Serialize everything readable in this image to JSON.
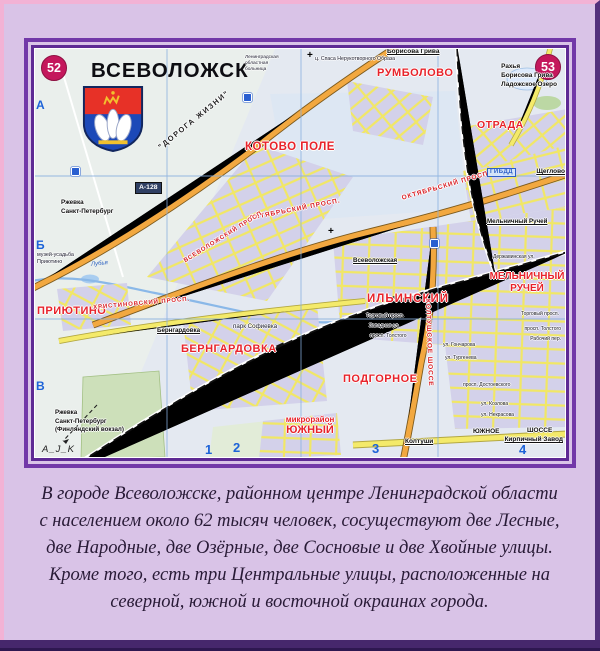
{
  "map": {
    "badge_left": "52",
    "badge_right": "53",
    "title": "ВСЕВОЛОЖСК",
    "districts": {
      "kotovo_pole": "КОТОВО ПОЛЕ",
      "rumbolovo": "РУМБОЛОВО",
      "otrada": "ОТРАДА",
      "priyutino": "ПРИЮТИНО",
      "berngardovka": "БЕРНГАРДОВКА",
      "ilyinsky": "ИЛЬИНСКИЙ",
      "melnichny_1": "МЕЛЬНИЧНЫЙ",
      "melnichny_2": "РУЧЕЙ",
      "podgornoe": "ПОДГОРНОЕ",
      "yuzhny_1": "микрорайон",
      "yuzhny_2": "ЮЖНЫЙ"
    },
    "roads": {
      "doroga_zhizni": "\"ДОРОГА ЖИЗНИ\"",
      "a128": "А-128",
      "oktyabrsky": "ОКТЯБРЬСКИЙ ПРОСП.",
      "koltushskoe": "КОЛТУШСКОЕ ШОССЕ",
      "khristinovsky": "ХРИСТИНОВСКИЙ ПРОСП.",
      "vsevolozhsky": "ВСЕВОЛОЖСКИЙ ПРОСП.",
      "yuzhnoe": "ЮЖНОЕ",
      "shosse": "ШОССЕ"
    },
    "stations": {
      "vsevolozhskaya": "Всеволожская",
      "berngardovka": "Бернгардовка",
      "melnichny_ruchey": "Мельничный Ручей"
    },
    "directions": {
      "borisova_griva": "Борисова Грива",
      "rakhya_1": "Рахья",
      "rakhya_2": "Борисова Грива",
      "rakhya_3": "Ладожское Озеро",
      "scheglovo": "Щеглово",
      "koltushi": "Колтуши",
      "kirpichny_zavod": "Кирпичный Завод",
      "rzhevka_1": "Ржевка",
      "rzhevka_2": "Санкт-Петербург",
      "rzhevka_b1": "Ржевка",
      "rzhevka_b2": "Санкт-Петербург",
      "rzhevka_b3": "(Финляндский вокзал)"
    },
    "poi": {
      "gibdd": "ГИБДД",
      "park_sofievka": "парк Софиевка",
      "museum_1": "музей-усадьба",
      "museum_2": "Приютино",
      "church": "ц. Спаса Нерукотворного Образа",
      "hospital_1": "Ленинградская",
      "hospital_2": "областная",
      "hospital_3": "больница",
      "lubya": "Лубья"
    },
    "streets": {
      "torgovy": "Торговый просп.",
      "zapadnaya": "Западная ул.",
      "tolstogo": "просп. Толстого",
      "goncharova": "ул. Гончарова",
      "turgeneva": "ул. Тургенева",
      "dostoevskogo": "просп. Достоевского",
      "kozlova": "ул. Козлова",
      "nekrasova": "ул. Некрасова",
      "rabochy": "Рабочий пер.",
      "derzhavinskaya": "Державинская ул."
    },
    "grid": {
      "c1": "1",
      "c2": "2",
      "c3": "3",
      "c4": "4",
      "ra": "А",
      "rb": "Б",
      "rv": "В"
    },
    "watermark": "A_J_K"
  },
  "caption": {
    "lines": [
      "В городе Всеволожске, районном центре Ленинградской области",
      "с населением около 62 тысяч человек, сосуществуют две Лесные,",
      "две Народные, две Озёрные, две Сосновые и две Хвойные улицы.",
      "Кроме того, есть три Центральные улицы, расположенные на",
      "северной, южной и восточной окраинах города."
    ]
  },
  "colors": {
    "frame_purple": "#7238a8",
    "outer_pink": "#f2b2d5",
    "lavender": "#d9c3e7",
    "district_red": "#e8232b",
    "badge_crimson": "#c4175c",
    "road_orange": "#f2a840",
    "road_yellow": "#f4ea6a",
    "water_blue": "#aecdf0",
    "grid_blue": "#1d63d8",
    "caption_ink": "#281a36",
    "bottom_band": "#46276c"
  }
}
